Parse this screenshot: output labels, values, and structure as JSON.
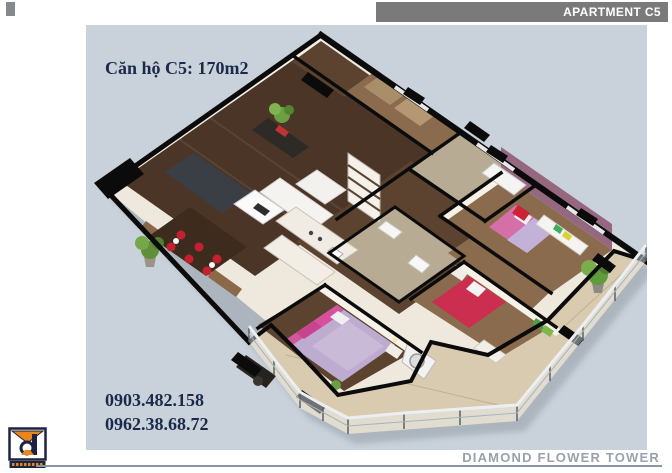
{
  "header": {
    "apartment_tag": "APARTMENT C5"
  },
  "floorplan": {
    "title": "Căn hộ C5: 170m2",
    "phones": [
      "0903.482.158",
      "0962.38.68.72"
    ]
  },
  "footer": {
    "building_name": "DIAMOND FLOWER TOWER"
  },
  "branding": {
    "logo_icon": "interior-design-company-logo"
  },
  "colors": {
    "panel_bg": "#c9d2da",
    "header_bar": "#7a7a7a",
    "navy": "#1b2a4a",
    "footer_gray": "#98a2ac",
    "rule_gray": "#8b95a0",
    "orange": "#e8861c",
    "logo_navy": "#1d2340",
    "wall": "#0b0b0b",
    "cream": "#efe9dd",
    "balcony": "#d8cbb0",
    "wood_dark": "#4a3526",
    "wood_mid": "#5b432f",
    "wood_light": "#8a6b4d",
    "tile": "#b7ac93",
    "mauve": "#95687f",
    "bed_pink": "#d2579d",
    "bed_red": "#cb2e4e",
    "lavender": "#bdaccf",
    "green": "#5f9a3c"
  }
}
